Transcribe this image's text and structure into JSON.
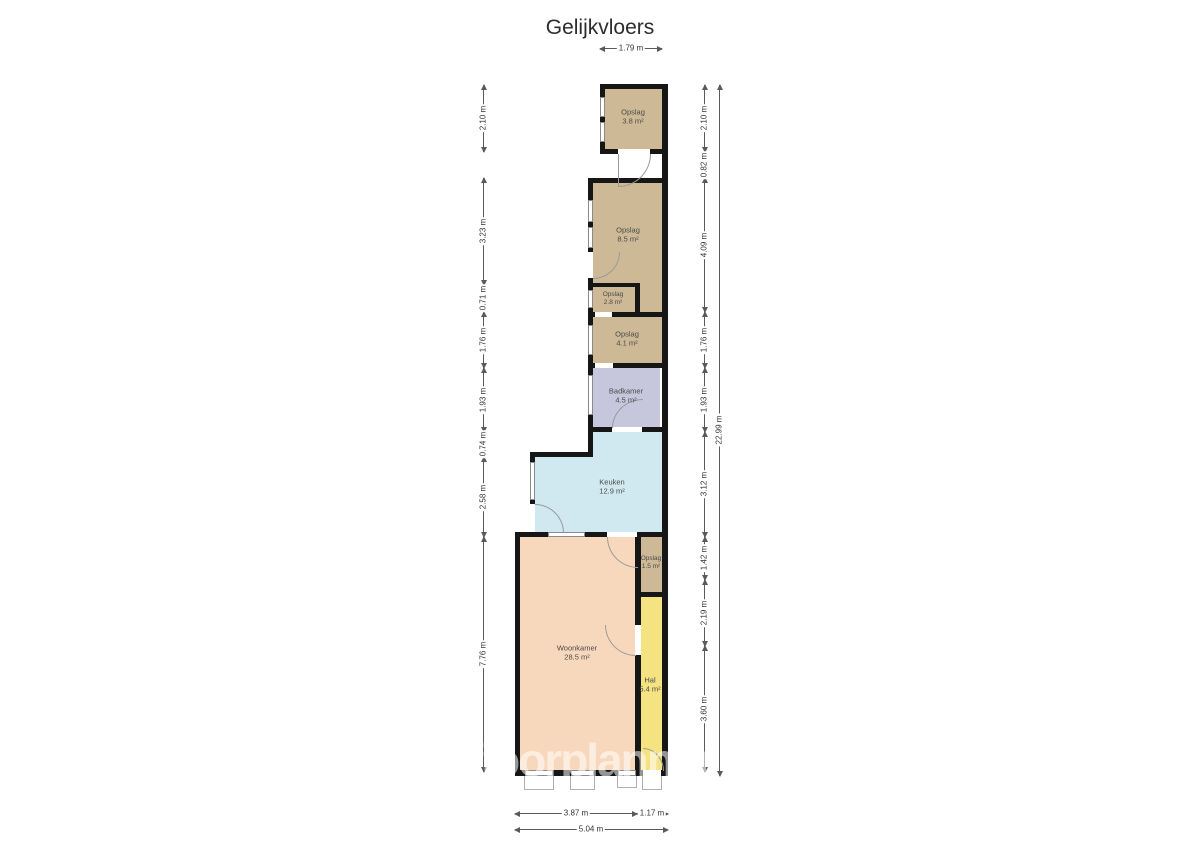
{
  "title": "Gelijkvloers",
  "watermark": "floorplanner",
  "colors": {
    "storage": "#cdb996",
    "bathroom": "#c6c6dd",
    "kitchen": "#d0e8f0",
    "living": "#f8d8bc",
    "hall": "#f5e280",
    "wall": "#161616"
  },
  "rooms": {
    "opslag_top": {
      "name": "Opslag",
      "area": "3.8 m²"
    },
    "opslag_large": {
      "name": "Opslag",
      "area": "8.5 m²"
    },
    "opslag_small": {
      "name": "Opslag",
      "area": "2.8 m²"
    },
    "opslag_mid": {
      "name": "Opslag",
      "area": "4.1 m²"
    },
    "badkamer": {
      "name": "Badkamer",
      "area": "4.5 m²"
    },
    "keuken": {
      "name": "Keuken",
      "area": "12.9 m²"
    },
    "opslag_tiny": {
      "name": "Opslag",
      "area": "1.5 m²"
    },
    "woonkamer": {
      "name": "Woonkamer",
      "area": "28.5 m²"
    },
    "hal": {
      "name": "Hal",
      "area": "5.4 m²"
    }
  },
  "dimensions": {
    "top": "1.79 m",
    "left": [
      "2.10 m",
      "3.23 m",
      "0.71 m",
      "1.76 m",
      "1.93 m",
      "0.74 m",
      "2.58 m",
      "7.76 m"
    ],
    "right": [
      "2.10 m",
      "0.82 m",
      "4.09 m",
      "1.76 m",
      "1.93 m",
      "3.12 m",
      "1.42 m",
      "2.19 m",
      "3.60 m"
    ],
    "right_total": "22.99 m",
    "bottom": [
      "3.87 m",
      "1.17 m"
    ],
    "bottom_total": "5.04 m"
  }
}
